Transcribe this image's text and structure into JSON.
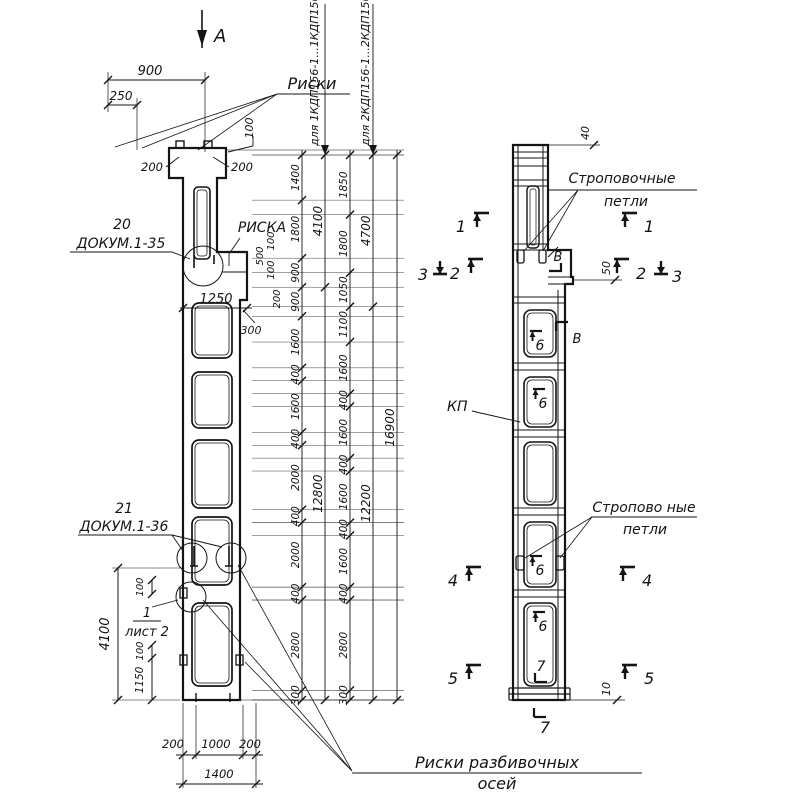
{
  "drawing": {
    "view_arrow": "А",
    "labels": {
      "riski": "Риски",
      "riska": "РИСКА",
      "detail20_num": "20",
      "detail20_doc": "ДОКУМ.1-35",
      "detail21_num": "21",
      "detail21_doc": "ДОКУМ.1-36",
      "sheet_num": "1",
      "sheet_ref": "лист 2",
      "axes_note_line1": "Риски разбивочных",
      "axes_note_line2": "осей",
      "sling_top_line1": "Строповочные",
      "sling_top_line2": "петли",
      "sling_bottom_line1": "Стропово ные",
      "sling_bottom_line2": "петли",
      "kp": "КП",
      "series1": "для 1КДП156-1...1КДП156-4",
      "series2": "для 2КДП156-1...2КДП156-7",
      "view_b": "В"
    },
    "sections": {
      "s1": "1",
      "s2": "2",
      "s3": "3",
      "s4": "4",
      "s5": "5",
      "s6": "6",
      "s7": "7"
    },
    "dims": {
      "top_900": "900",
      "top_250": "250",
      "top_200l": "200",
      "top_200r": "200",
      "top_100": "100",
      "corbel_1250": "1250",
      "corbel_500": "500",
      "corbel_100a": "100",
      "corbel_100b": "100",
      "corbel_200": "200",
      "corbel_300": "300",
      "left_4100": "4100",
      "left_100a": "100",
      "left_100b": "100",
      "left_1150": "1150",
      "bottom_200l": "200",
      "bottom_1000": "1000",
      "bottom_200r": "200",
      "bottom_1400": "1400",
      "side_40": "40",
      "side_50": "50",
      "side_10": "10"
    },
    "dim_chains": {
      "chainA": [
        "1400",
        "1800",
        "900",
        "900",
        "1600",
        "400",
        "1600",
        "400",
        "2000",
        "400",
        "2000",
        "400",
        "2800",
        "300"
      ],
      "overallA": [
        "4100",
        "12800"
      ],
      "chainB": [
        "1850",
        "1800",
        "1050",
        "1100",
        "1600",
        "400",
        "1600",
        "400",
        "1600",
        "400",
        "1600",
        "400",
        "2800",
        "300"
      ],
      "overallB": [
        "4700",
        "12200"
      ],
      "total": [
        "16900"
      ]
    }
  }
}
